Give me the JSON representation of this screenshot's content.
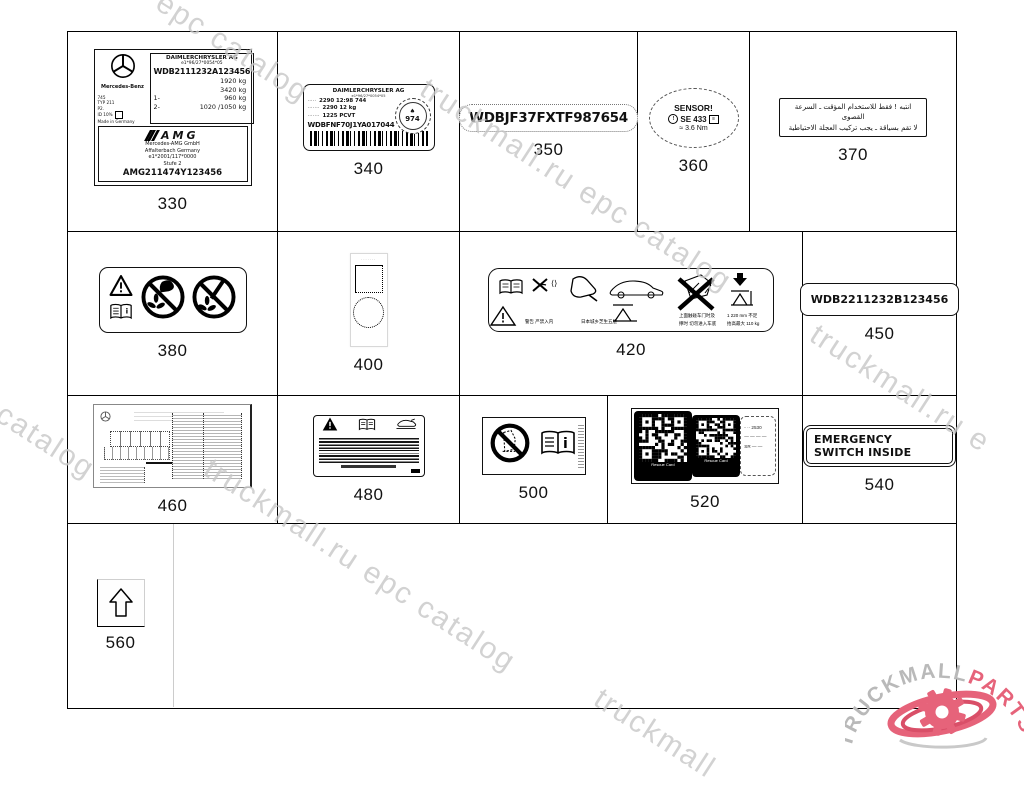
{
  "watermarks": {
    "w1": "epc catalog",
    "w2": "truckmall.ru epc catalog",
    "w3": "l epc catalog",
    "w4": "truckmall.ru e",
    "w5": "truckmall.ru epc catalog",
    "w6": "truckmall"
  },
  "logo": {
    "gray": "TRUCKMALL",
    "red": "PARTS",
    "gray_color": "#b9b9b9",
    "red_color": "#e6637a"
  },
  "labels": {
    "l330": {
      "number": "330",
      "brand": "Mercedes-Benz",
      "maker": "DAIMLERCHRYSLER AG",
      "approval": "e1*96/27*0054*05",
      "vin": "WDB2111232A123456",
      "w1": "1920 kg",
      "w2": "3420 kg",
      "w3l": "1-",
      "w3": "960 kg",
      "w4l": "2-",
      "w4": "1020 /1050 kg",
      "s1": "745",
      "s2": "TYP 211",
      "s3": "P2.",
      "s4": "ID 10%",
      "s5": "Made in Germany",
      "amg": "AMG",
      "a1": "Mercedes-AMG GmbH",
      "a2": "Affalterbach Germany",
      "a3": "e1*2001/117*0000",
      "a4": "Stufe 2",
      "amg_vin": "AMG211474Y123456"
    },
    "l340": {
      "number": "340",
      "header": "DAIMLERCHRYSLER AG",
      "sub": "e1*96/27*0054*05",
      "r1k": "·····",
      "r1v": "2290  12:98  744",
      "r2k": "·······",
      "r2v": "2290  12 kg",
      "r3k": "·······",
      "r3v": "1225 PCVT",
      "vin": "WDBFNF70J1YA017044",
      "stamp_leaf": "♠",
      "stamp": "974"
    },
    "l350": {
      "number": "350",
      "vin": "WDBJF37FXTF987654"
    },
    "l360": {
      "number": "360",
      "line1": "SENSOR!",
      "ic1": "!",
      "se": "SE  433",
      "ic2": "≡",
      "nm": "≈ 3.6 Nm"
    },
    "l370": {
      "number": "370",
      "ar1": "انتبه ! فقط للاستخدام المؤقت ـ السرعة القصوى",
      "ar2": "لا تقم بسياقة ـ يجب تركيب العجلة الاحتياطية"
    },
    "l380": {
      "number": "380"
    },
    "l400": {
      "number": "400",
      "top": "∙∙∙∙∙∙∙"
    },
    "l420": {
      "number": "420",
      "c1": "警告 严禁入内",
      "c2": "日本城乡芝生五层",
      "c3": "上面触碰车门时及",
      "c4": "撑时 切勿进入车底",
      "c5": "1 220 mm  不足",
      "c6": "抬高最大 110 kg"
    },
    "l450": {
      "number": "450",
      "vin": "WDB2211232B123456"
    },
    "l460": {
      "number": "460"
    },
    "l480": {
      "number": "480"
    },
    "l500": {
      "number": "500"
    },
    "l520": {
      "number": "520",
      "cap1": "Rescue Card",
      "cap2": "Rescue Card",
      "p1": "‑ ·· 2530",
      "p2": "— — — —",
      "p3": "SR — —"
    },
    "l540": {
      "number": "540",
      "text": "EMERGENCY SWITCH INSIDE"
    },
    "l560": {
      "number": "560"
    }
  }
}
